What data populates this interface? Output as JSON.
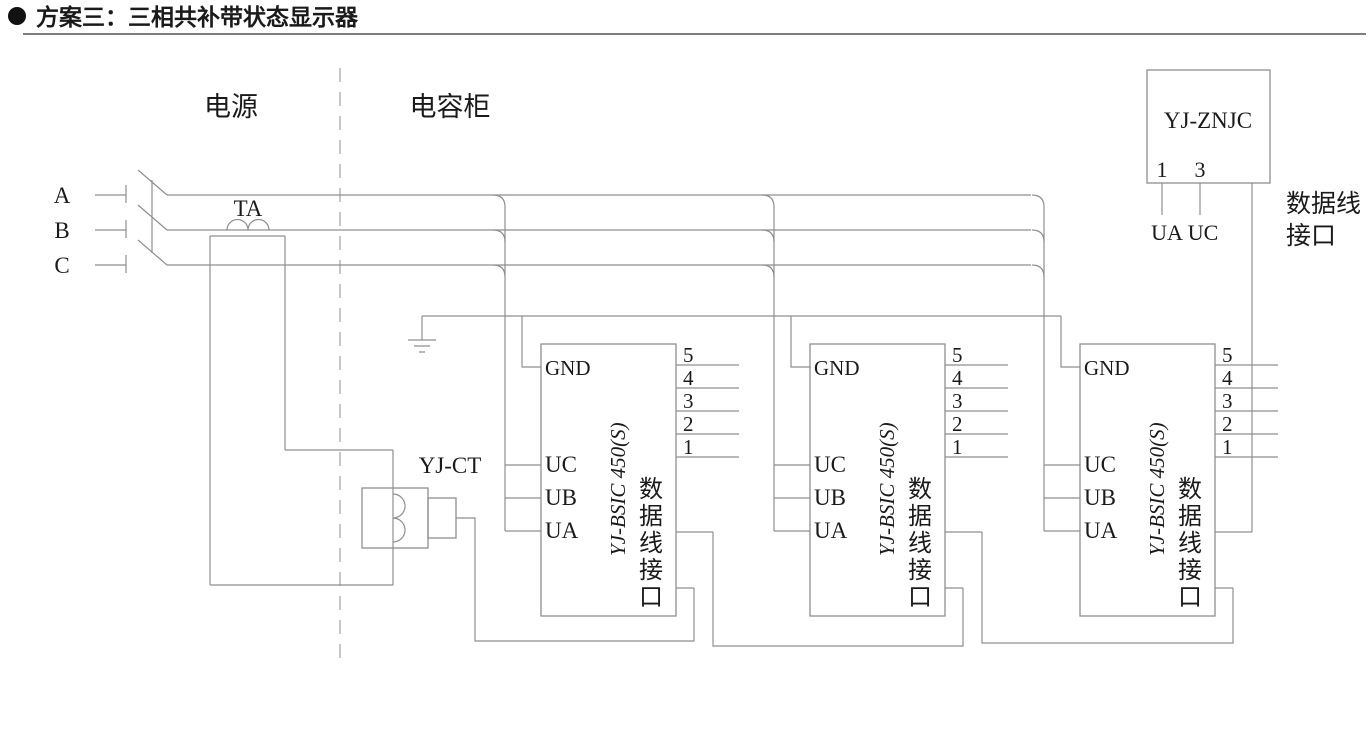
{
  "header": {
    "bullet": "●",
    "title": "方案三：三相共补带状态显示器"
  },
  "zones": {
    "power": "电源",
    "capacitor": "电容柜"
  },
  "phases": {
    "a": "A",
    "b": "B",
    "c": "C"
  },
  "ta_label": "TA",
  "ct_label": "YJ-CT",
  "module": {
    "name": "YJ-BSIC 450(S)",
    "gnd": "GND",
    "uc": "UC",
    "ub": "UB",
    "ua": "UA",
    "pins": [
      "5",
      "4",
      "3",
      "2",
      "1"
    ],
    "port_chars": [
      "数",
      "据",
      "线",
      "接",
      "口"
    ]
  },
  "znjc": {
    "name": "YJ-ZNJC",
    "pin_left": "1",
    "pin_right": "3",
    "ua": "UA",
    "uc": "UC",
    "data_label_1": "数据线",
    "data_label_2": "接口"
  },
  "colors": {
    "wire": "#8f8f8f",
    "text": "#1a1a1a"
  }
}
